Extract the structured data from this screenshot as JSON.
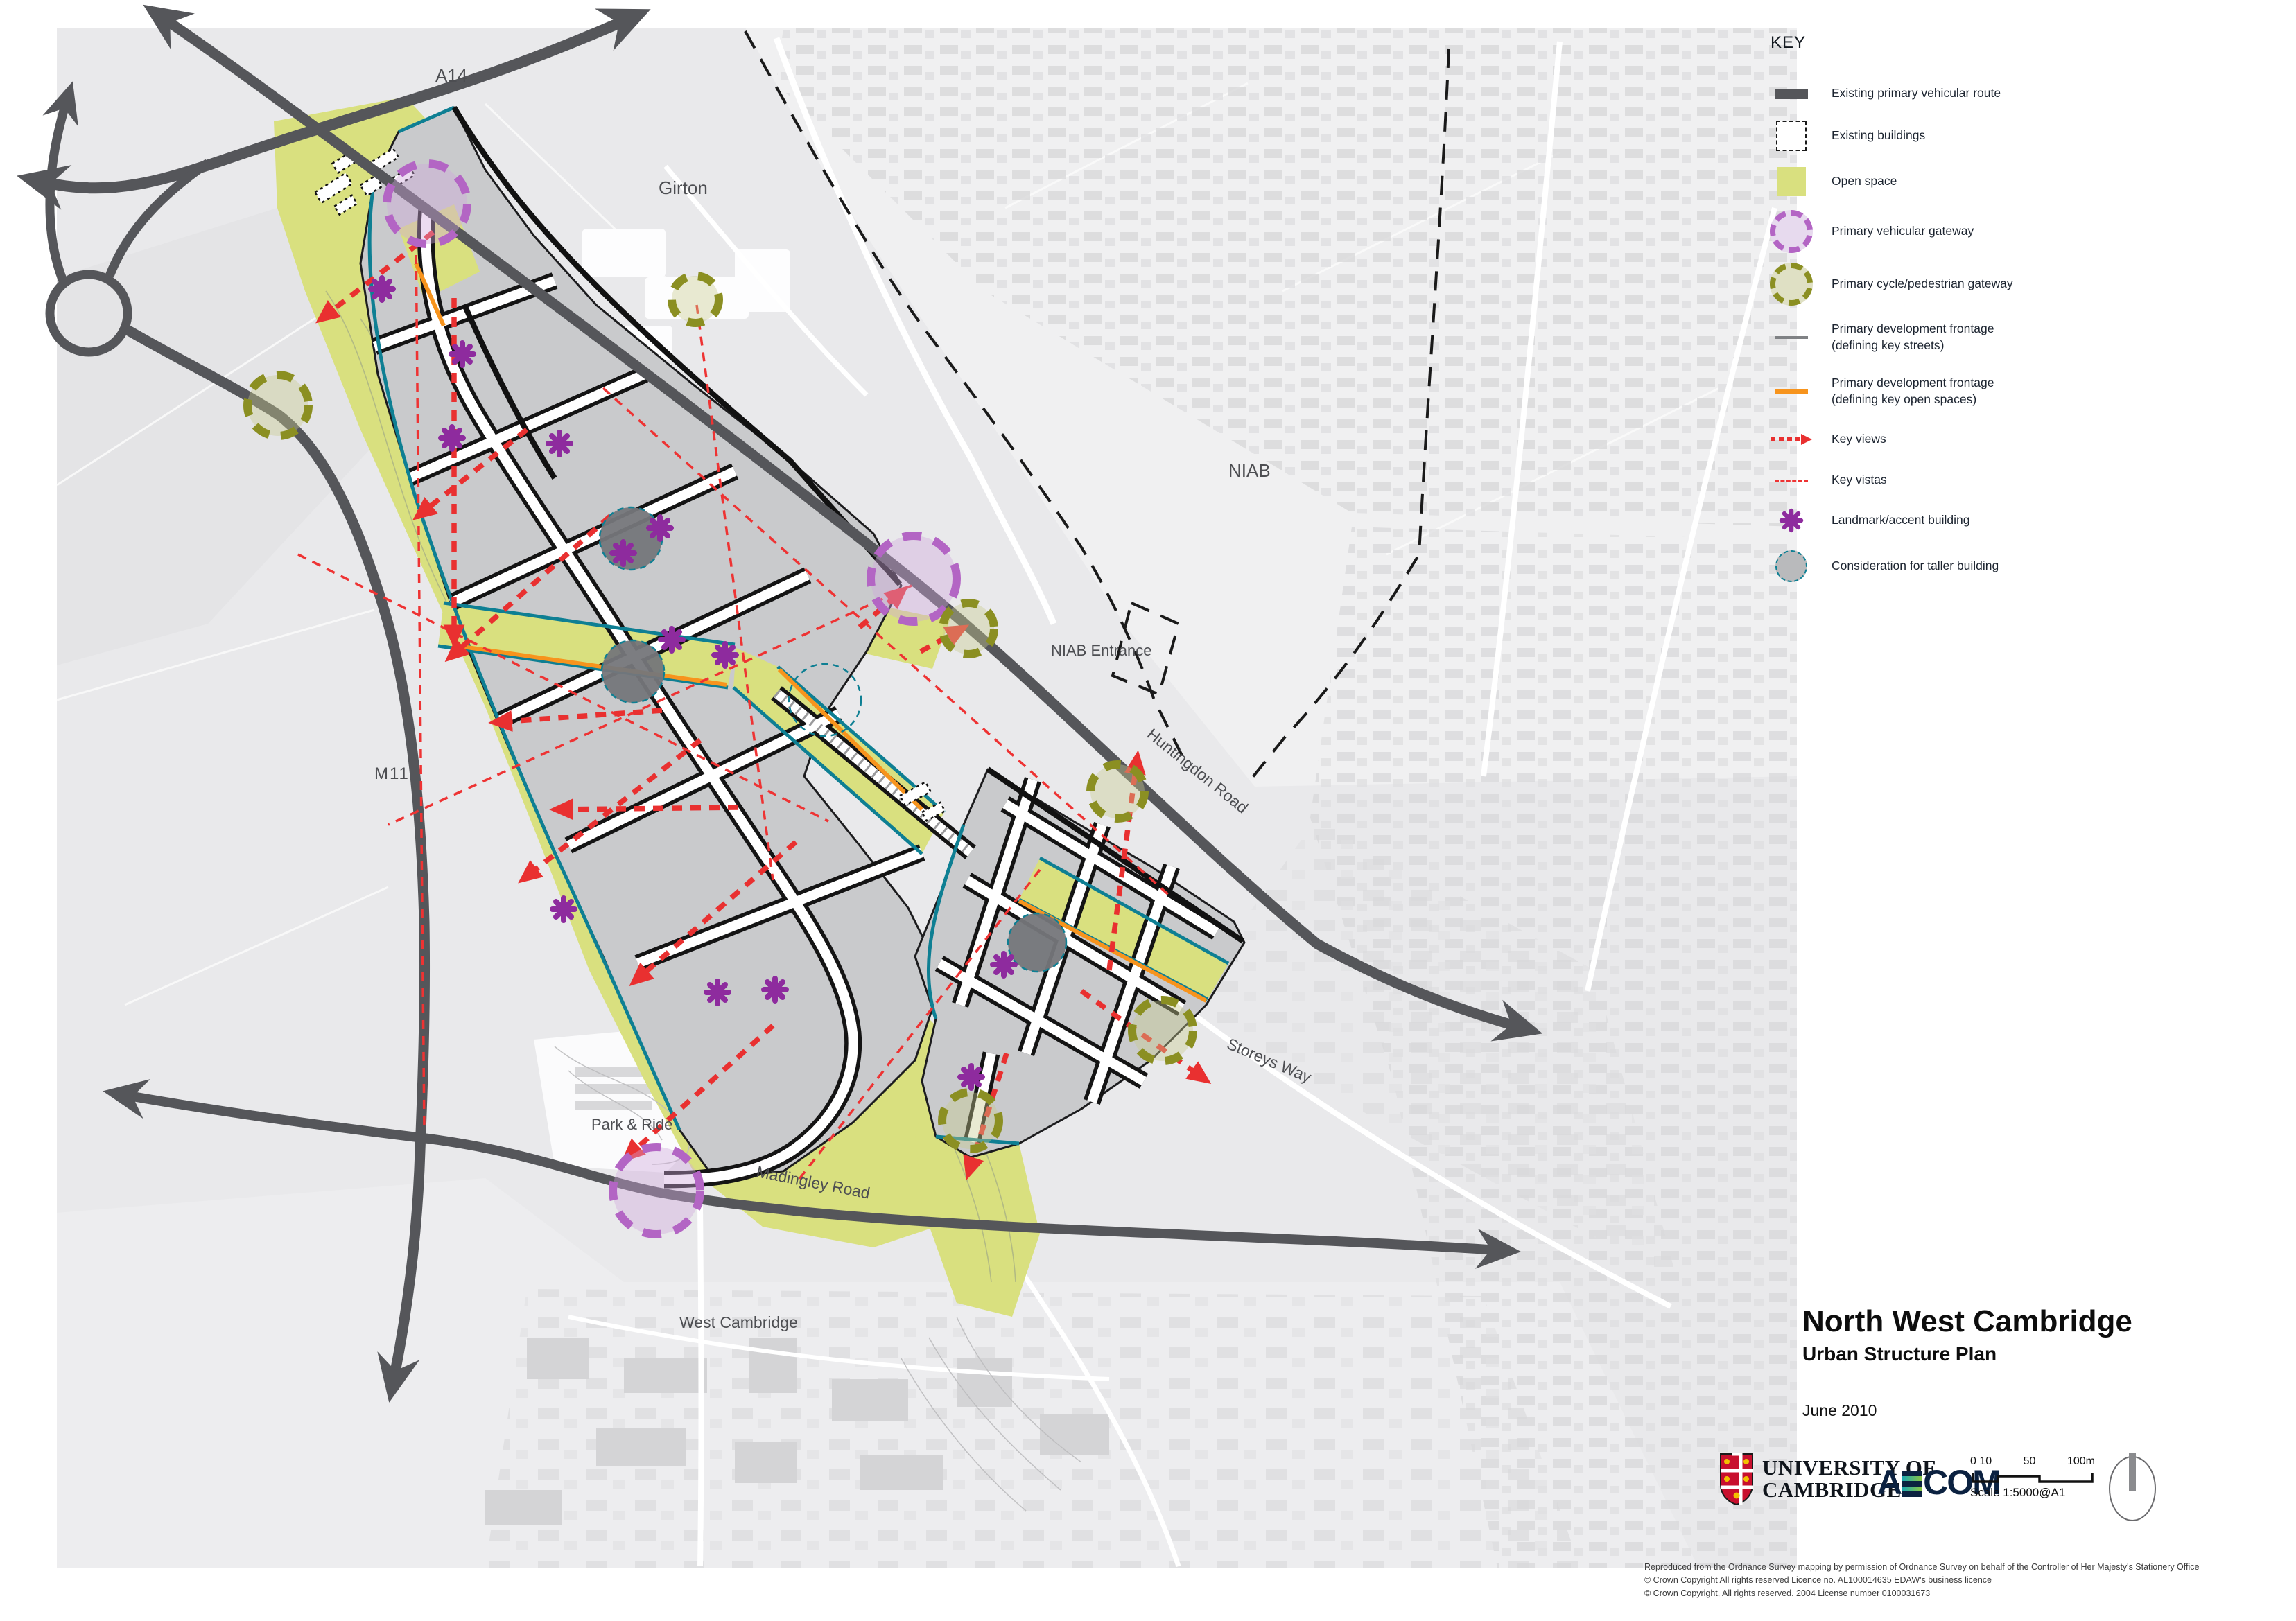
{
  "title_block": {
    "title": "North West Cambridge",
    "subtitle": "Urban Structure Plan",
    "date": "June 2010"
  },
  "legend": {
    "heading": "KEY",
    "items": [
      {
        "id": "existing-primary-vehicular-route",
        "label": "Existing primary vehicular route",
        "symbol": "thick-dark-bar",
        "color": "#55565a"
      },
      {
        "id": "existing-buildings",
        "label": "Existing buildings",
        "symbol": "dashed-square",
        "color": "#1a1a1a"
      },
      {
        "id": "open-space",
        "label": "Open space",
        "symbol": "green-square",
        "color": "#d9e07f"
      },
      {
        "id": "primary-vehicular-gateway",
        "label": "Primary vehicular gateway",
        "symbol": "purple-dashed-circle",
        "color": "#b365c4"
      },
      {
        "id": "primary-cycle-pedestrian-gateway",
        "label": "Primary cycle/pedestrian gateway",
        "symbol": "olive-dashed-circle",
        "color": "#8b8f22"
      },
      {
        "id": "frontage-key-streets",
        "label": "Primary development frontage (defining key streets)",
        "symbol": "gray-line",
        "color": "#808285"
      },
      {
        "id": "frontage-key-open-spaces",
        "label": "Primary development frontage (defining key open spaces)",
        "symbol": "orange-line",
        "color": "#f7941d"
      },
      {
        "id": "key-views",
        "label": "Key views",
        "symbol": "red-dotted-arrow",
        "color": "#e93030"
      },
      {
        "id": "key-vistas",
        "label": "Key vistas",
        "symbol": "red-dashed-line",
        "color": "#ee3333"
      },
      {
        "id": "landmark-accent-building",
        "label": "Landmark/accent building",
        "symbol": "purple-asterisk",
        "color": "#8e2b9e"
      },
      {
        "id": "consideration-taller-building",
        "label": "Consideration for taller building",
        "symbol": "gray-circle-teal-dash",
        "color": "#808285"
      }
    ]
  },
  "map": {
    "labels": {
      "a14": "A14",
      "girton": "Girton",
      "niab": "NIAB",
      "niab_entrance": "NIAB Entrance",
      "huntingdon_road": "Huntingdon Road",
      "m11": "M11",
      "storeys_way": "Storeys Way",
      "park_and_ride": "Park & Ride",
      "madingley_road": "Madingley Road",
      "west_cambridge": "West Cambridge"
    }
  },
  "footer": {
    "university": {
      "line1": "UNIVERSITY OF",
      "line2": "CAMBRIDGE"
    },
    "aecom_a": "A",
    "aecom_com": "COM",
    "scale": {
      "tick0": "0 10",
      "tick50": "50",
      "tick100": "100m",
      "label": "Scale 1:5000@A1"
    },
    "copyright": {
      "line1": "Reproduced from the Ordnance Survey mapping by permission of Ordnance Survey on behalf of the Controller of Her Majesty's Stationery Office",
      "line2": "© Crown Copyright All rights reserved Licence no. AL100014635 EDAW's business licence",
      "line3": "© Crown Copyright, All rights reserved. 2004 License number 0100031673"
    }
  }
}
